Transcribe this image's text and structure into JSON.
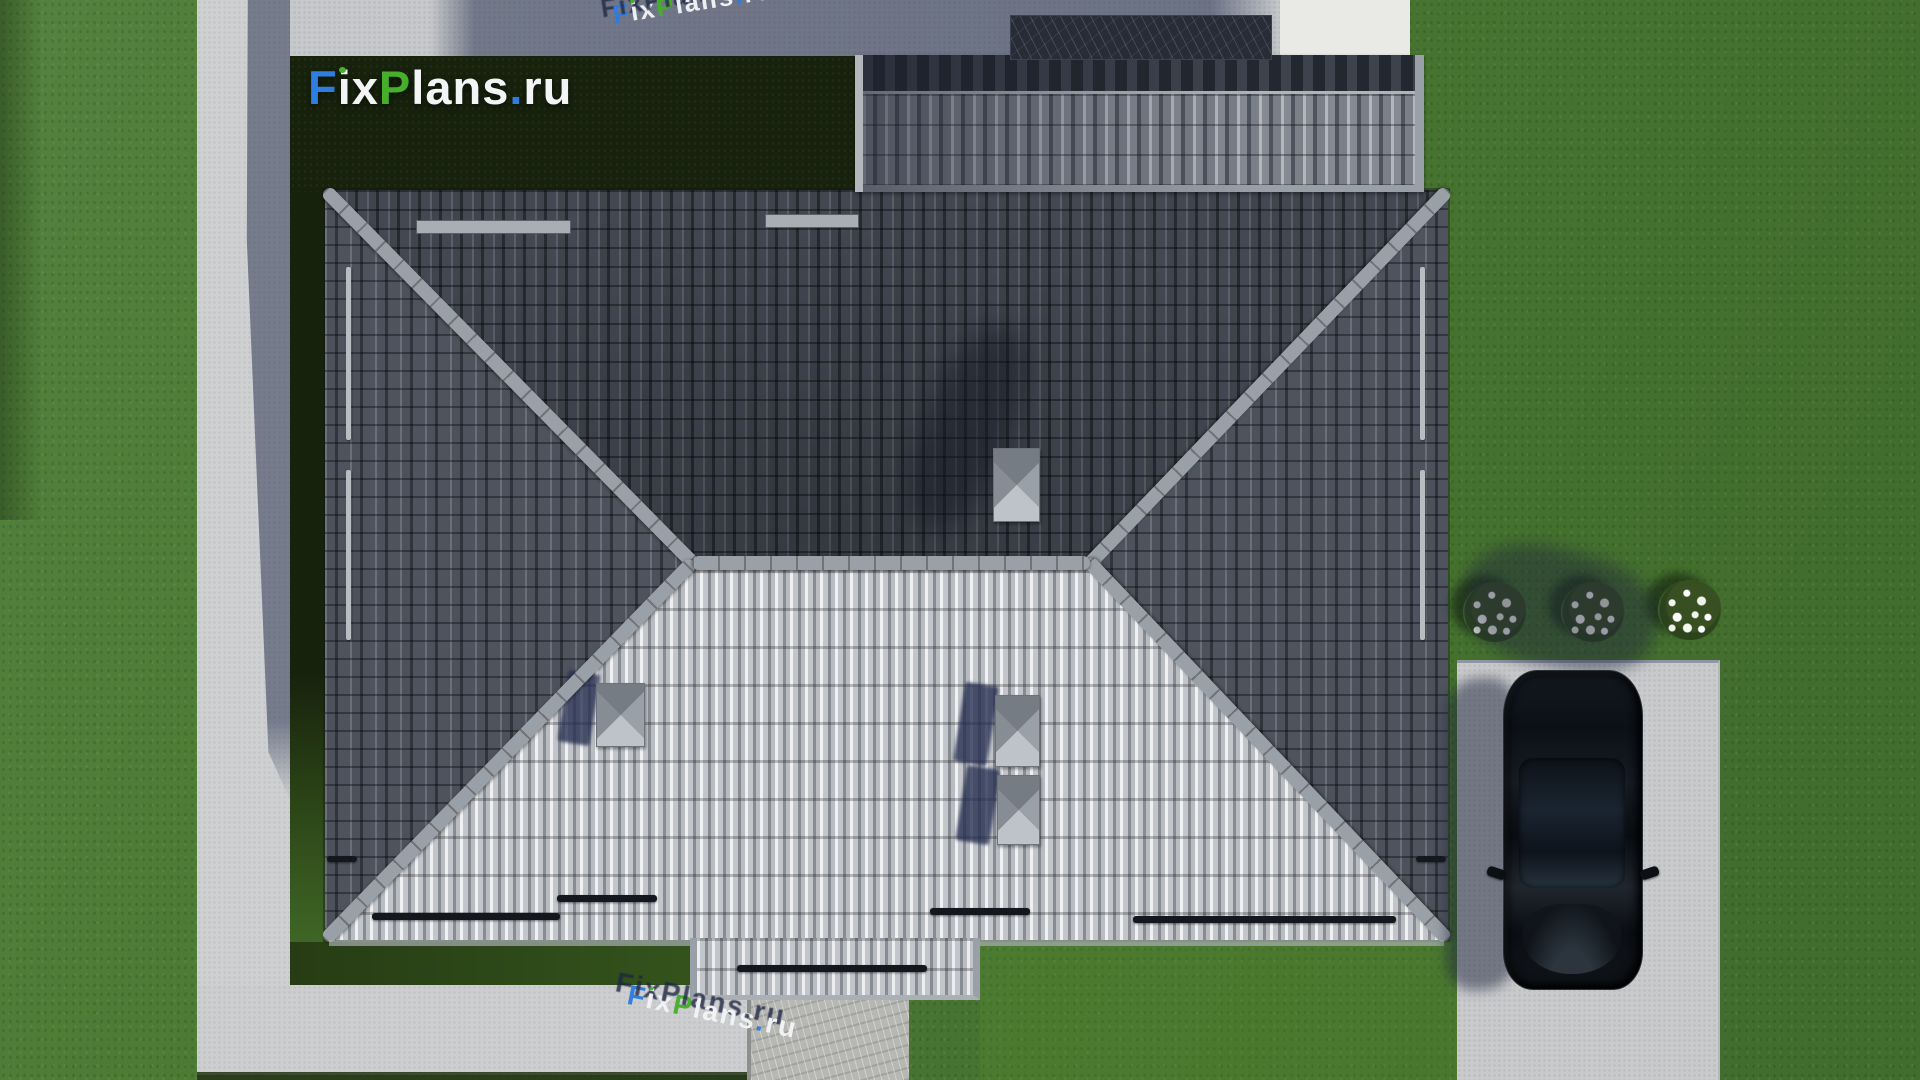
{
  "brand": {
    "name": "FixPlans.ru",
    "f": "F",
    "i": "i",
    "x": "x",
    "p": "P",
    "lans": "lans",
    "dot": ".",
    "ru": "ru",
    "color_blue": "#2e7de0",
    "color_green": "#46b02a",
    "color_white": "#f2f4f6"
  },
  "watermarks": {
    "top_text": "FixPlans.ru",
    "bottom_text": "FixPlans.ru"
  },
  "scene": {
    "description": "Top-down aerial 3D render of a single-family house with gray tiled hip roof",
    "objects": {
      "main_roof": "hip roof with four tiled slopes, light sunlit south slope and dark north slope",
      "garage_roof": "upper secondary roof section with vertical barrel tiles",
      "porch_roof": "small lower roof extension over entry",
      "roof_vents": "4 gray pyramid roof vents casting navy shadows",
      "snow_guards": "dark horizontal bars near eaves",
      "ridge_and_hips": "light gray ridge and hip cap tiles",
      "car": "black car parked on concrete driveway, top view, shadow cast to the left",
      "driveway": "light concrete driveway at right",
      "flower_bushes": "3 round bushes with white flowers",
      "bush_count": 3,
      "paths": "L-shaped concrete sidewalk at left/top and wide path at bottom",
      "entry_walkway": "textured stamped-concrete walkway below porch",
      "lawn": "green lawn, deep shadow of the house over the front lawn",
      "slate_patch": "dark textured flat-roof patch above garage roof"
    },
    "palette": {
      "grass": "#4a7a32",
      "grass_shadow": "#16200d",
      "path": "#cfd0d2",
      "path_sunlit": "#e9e9e7",
      "path_shadow": "#2c3652",
      "roof_dark": "#3a3f48",
      "roof_side": "#4a4f58",
      "roof_light": "#d7dade",
      "ridge": "#9aa0a7",
      "vent": "#8f959d",
      "shadow_navy": "#2b3454",
      "driveway": "#c9cacc",
      "car": "#0b0e13"
    }
  }
}
